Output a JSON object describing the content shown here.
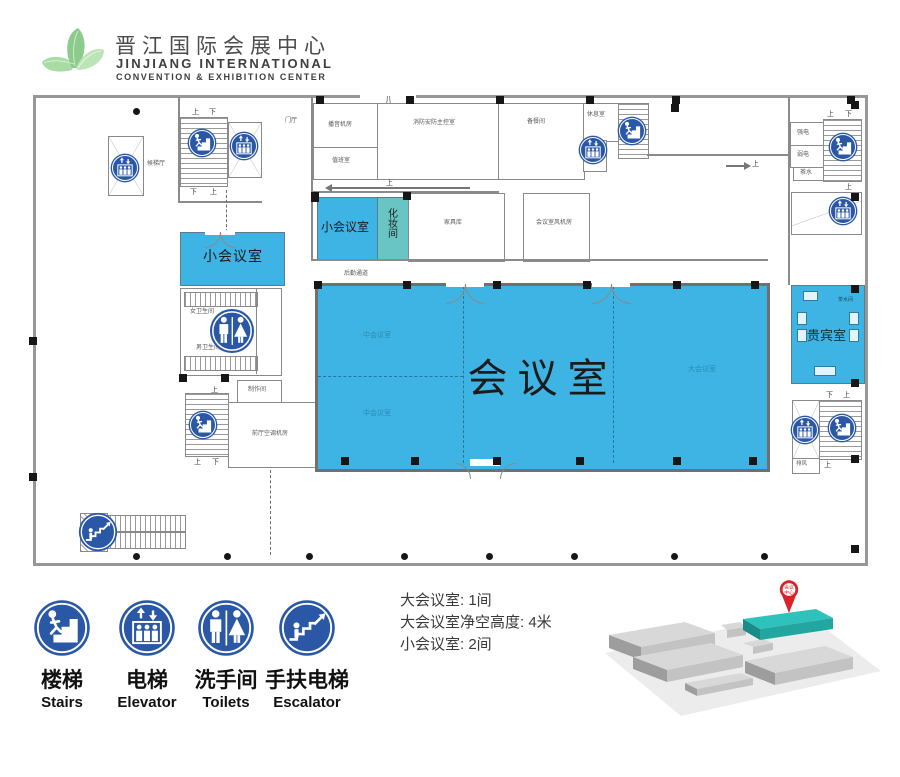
{
  "header": {
    "title_zh": "晋江国际会展中心",
    "title_en_line1": "JINJIANG  INTERNATIONAL",
    "title_en_line2": "CONVENTION & EXHIBITION   CENTER"
  },
  "plan": {
    "halls": {
      "main": "会议室",
      "mid_top": "中会议室",
      "mid_bottom": "中会议室",
      "large": "大会议室",
      "small_top": "小会议室",
      "small_left": "小会议室",
      "dressing": "化妆间",
      "vip": "贵宾室"
    },
    "rooms": {
      "broadcast": "播音机房",
      "duty": "值班室",
      "fire_control": "消防安防主控室",
      "pantry": "备餐间",
      "lounge": "休息室",
      "furniture_store": "家具库",
      "fan_room": "会议室风机房",
      "logistics": "后勤通道",
      "lift_lobby": "候梯厅",
      "entrance": "门厅",
      "womens_toilet": "女卫生间",
      "mens_toilet": "男卫生间",
      "workshop": "制作间",
      "ac_room": "前厅空调机房",
      "strong_power": "强电",
      "weak_power": "弱电",
      "tea": "茶水",
      "tea_room": "茶水间",
      "exhaust": "排风"
    },
    "dir": {
      "up": "上",
      "down": "下"
    }
  },
  "legend": {
    "items": [
      {
        "icon": "stairs-icon",
        "zh": "楼梯",
        "en": "Stairs"
      },
      {
        "icon": "elevator-icon",
        "zh": "电梯",
        "en": "Elevator"
      },
      {
        "icon": "toilets-icon",
        "zh": "洗手间",
        "en": "Toilets"
      },
      {
        "icon": "escalator-icon",
        "zh": "手扶电梯",
        "en": "Escalator"
      }
    ]
  },
  "info": {
    "lines": [
      "大会议室: 1间",
      "大会议室净空高度: 4米",
      "小会议室: 2间"
    ]
  },
  "minimap": {
    "pin_line1": "会议",
    "pin_line2": "中心"
  },
  "colors": {
    "room_highlight": "#3db4e3",
    "dressing_room": "#68c5c3",
    "icon_badge": "#2a58a6",
    "minimap_highlight": "#2fc2bd",
    "pin_red": "#d8232a",
    "wall_gray": "#8a8a8a",
    "logo_green": "#8bcb8b"
  }
}
